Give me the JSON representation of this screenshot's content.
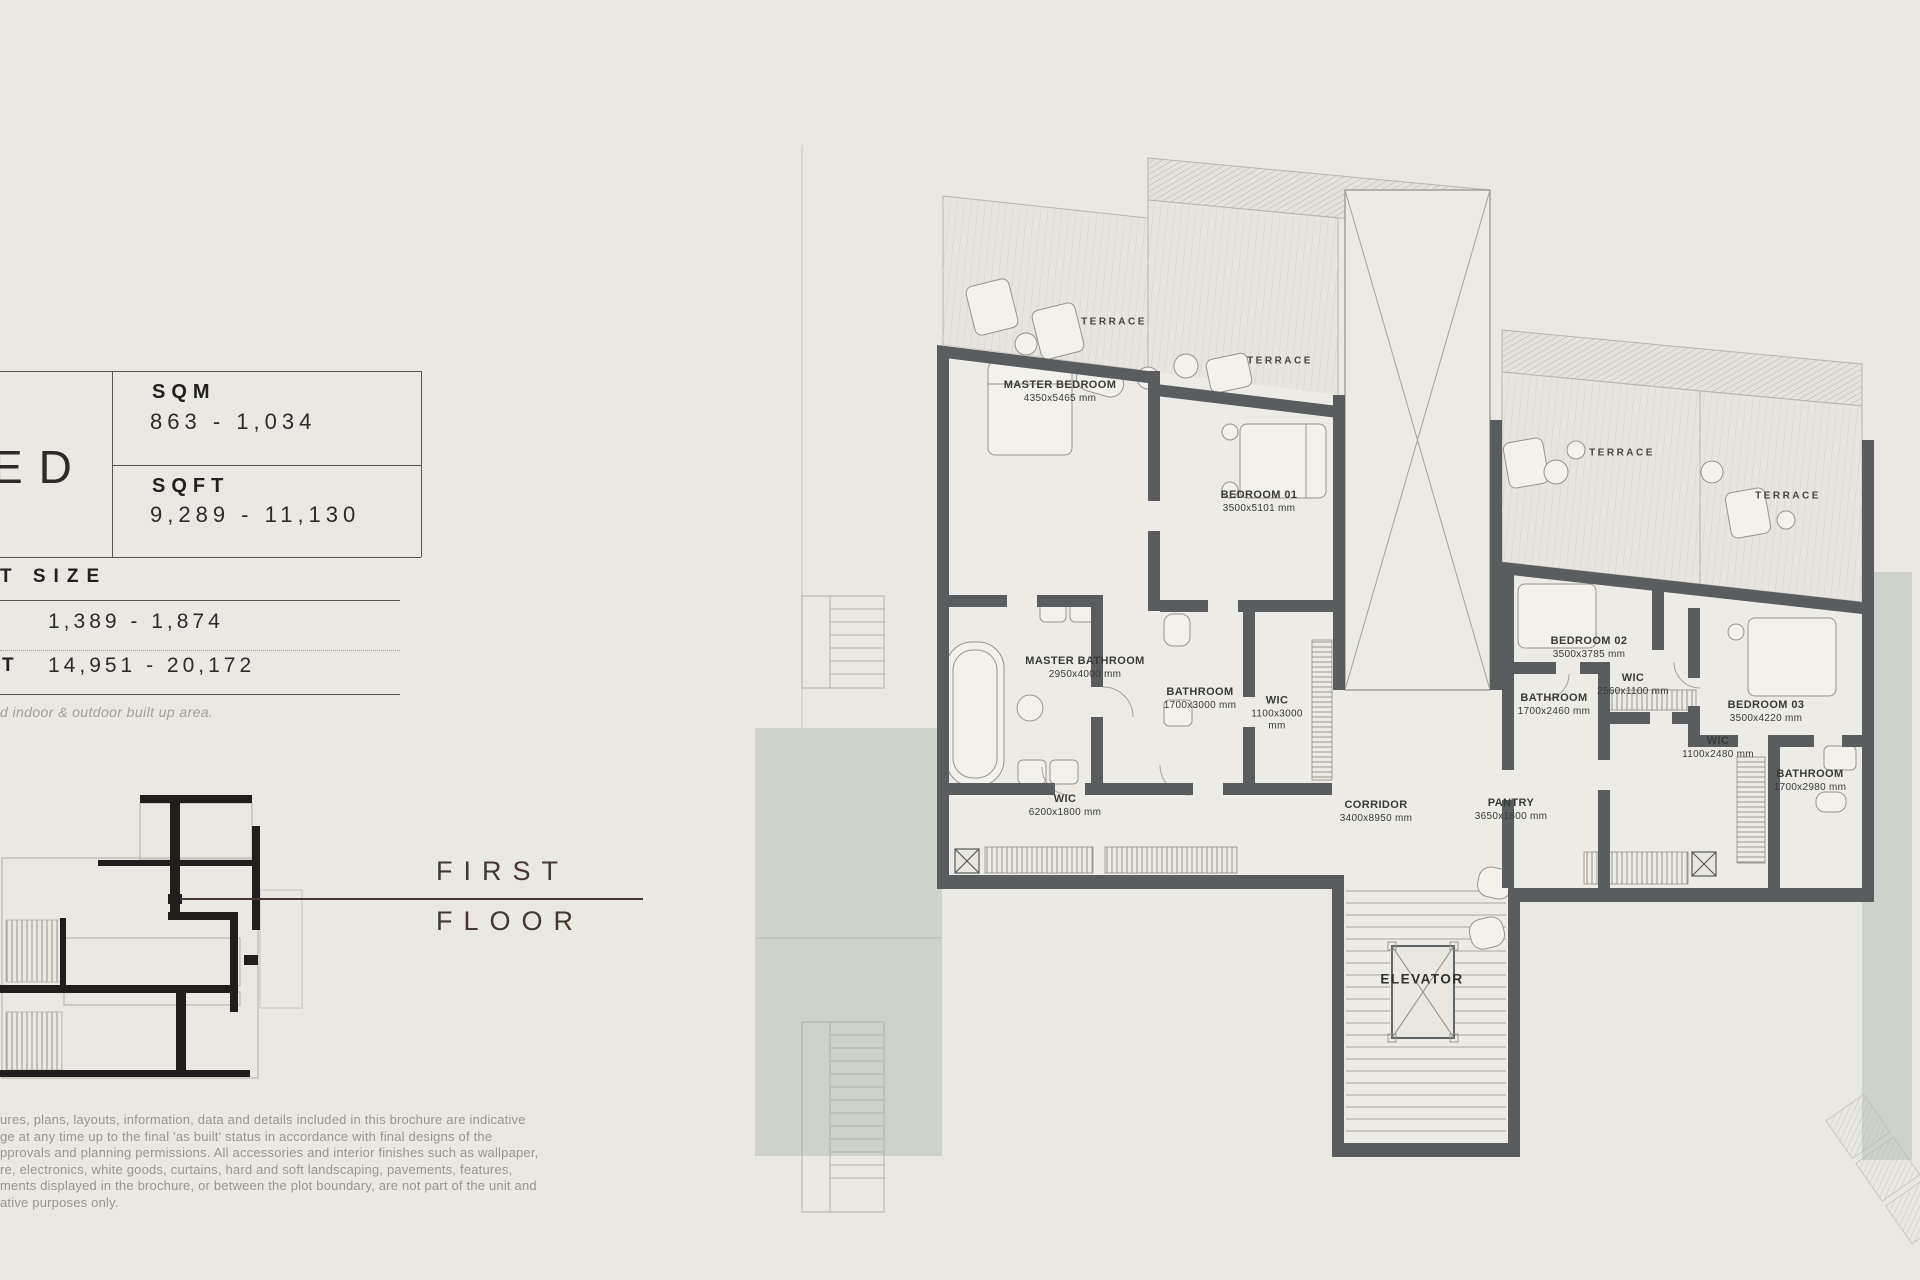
{
  "colors": {
    "background": "#eae8e2",
    "wall": "#595d5f",
    "landscape_green": "#cdd3c9",
    "accent_brown": "#46362e",
    "text_dark": "#2c2b29",
    "text_gray": "#9b948b"
  },
  "panel": {
    "bed_suffix": "ED",
    "area_rows": [
      {
        "label": "SQM",
        "value": "863 - 1,034"
      },
      {
        "label": "SQFT",
        "value": "9,289 - 11,130"
      }
    ],
    "plot": {
      "header": "T SIZE",
      "row1_value": "1,389 - 1,874",
      "row2_label": "T",
      "row2_value": "14,951 - 20,172"
    },
    "footnote": "d indoor & outdoor built up area."
  },
  "floor_label": {
    "line1": "FIRST",
    "line2": "FLOOR"
  },
  "disclaimer": {
    "lines": [
      "ures, plans, layouts, information, data and details included in this brochure are indicative",
      "ge at any time up to the final 'as built' status in accordance with final designs of the",
      "pprovals and planning permissions. All accessories and interior finishes such as wallpaper,",
      "re, electronics, white goods, curtains, hard and soft landscaping, pavements, features,",
      "ments displayed in the brochure, or between the plot boundary, are not part of the unit and",
      "ative purposes only."
    ]
  },
  "plan": {
    "terraces": [
      "TERRACE",
      "TERRACE",
      "TERRACE",
      "TERRACE"
    ],
    "rooms": [
      {
        "name": "MASTER BEDROOM",
        "dims": "4350x5465 mm"
      },
      {
        "name": "BEDROOM 01",
        "dims": "3500x5101 mm"
      },
      {
        "name": "MASTER BATHROOM",
        "dims": "2950x4000 mm"
      },
      {
        "name": "BATHROOM",
        "dims": "1700x3000 mm"
      },
      {
        "name": "WIC",
        "dims": "1100x3000 mm"
      },
      {
        "name": "WIC",
        "dims": "6200x1800 mm"
      },
      {
        "name": "CORRIDOR",
        "dims": "3400x8950 mm"
      },
      {
        "name": "PANTRY",
        "dims": "3650x1800 mm"
      },
      {
        "name": "BEDROOM 02",
        "dims": "3500x3785 mm"
      },
      {
        "name": "WIC",
        "dims": "2560x1100 mm"
      },
      {
        "name": "BATHROOM",
        "dims": "1700x2460 mm"
      },
      {
        "name": "BEDROOM 03",
        "dims": "3500x4220 mm"
      },
      {
        "name": "WIC",
        "dims": "1100x2480 mm"
      },
      {
        "name": "BATHROOM",
        "dims": "1700x2980 mm"
      }
    ],
    "elevator": "ELEVATOR"
  }
}
